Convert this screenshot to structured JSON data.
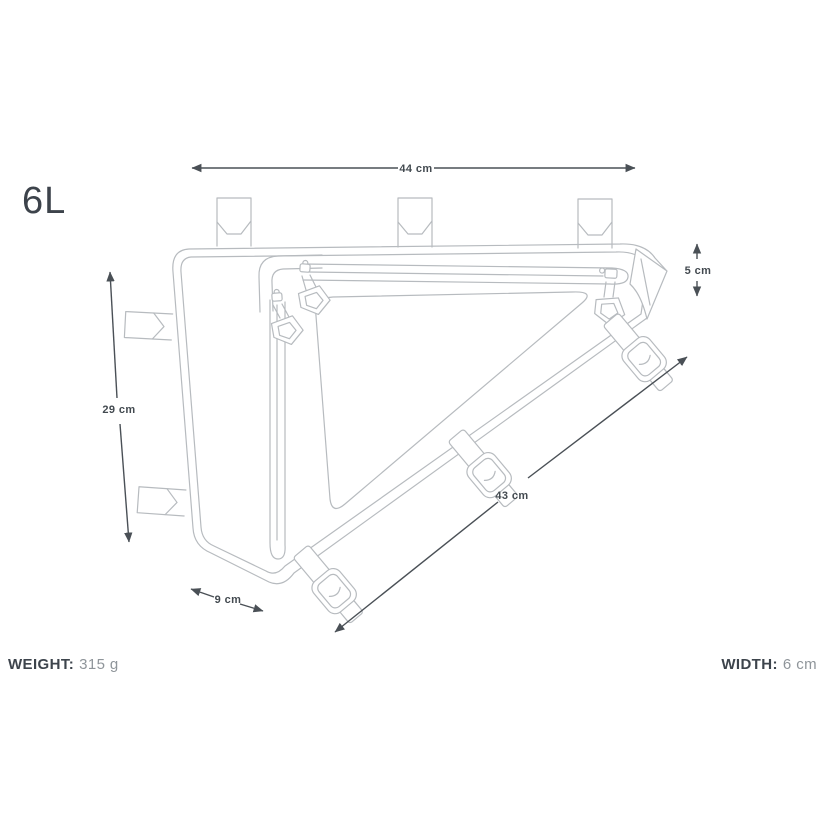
{
  "title": {
    "volume": "6L"
  },
  "dimensions": {
    "top_width": "44 cm",
    "right_depth": "5 cm",
    "left_height": "29 cm",
    "hypotenuse": "43 cm",
    "bottom": "9 cm"
  },
  "specs": {
    "weight_label": "WEIGHT:",
    "weight_value": "315 g",
    "width_label": "WIDTH:",
    "width_value": "6 cm"
  },
  "colors": {
    "background": "#ffffff",
    "line_art": "#b7bbbf",
    "dimension_lines": "#4a5056",
    "text_dark": "#3d444c",
    "text_muted": "#8f959a"
  }
}
